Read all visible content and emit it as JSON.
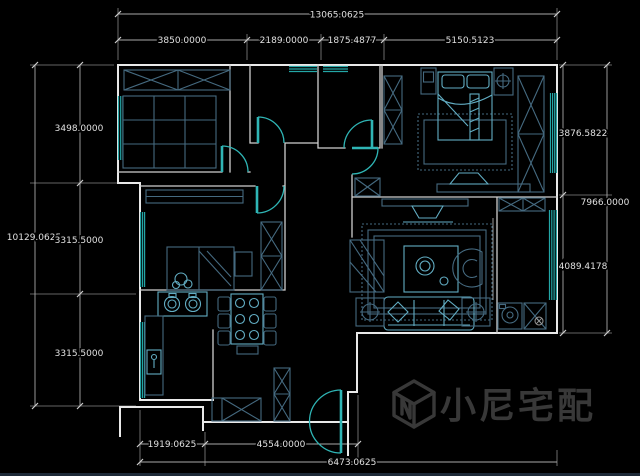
{
  "drawing": {
    "kind": "cad-floor-plan",
    "units": "mm"
  },
  "dimensions": {
    "top": {
      "overall": "13065.0625",
      "segments": [
        "3850.0000",
        "2189.0000",
        "1875.4877",
        "5150.5123"
      ]
    },
    "left": {
      "overall": "10129.0625",
      "segments": [
        "3498.0000",
        "3315.5000",
        "3315.5000"
      ]
    },
    "right": {
      "overall": "7966.0000",
      "segments": [
        "3876.5822",
        "4089.4178"
      ]
    },
    "bottom": {
      "overall": "6473.0625",
      "segments": [
        "1919.0625",
        "4554.0000"
      ]
    }
  },
  "watermark": {
    "text": "小尼宅配",
    "logo": "cube-n-logo"
  },
  "colors": {
    "background": "#000000",
    "wall": "#e9e9e9",
    "dimension_line": "#a8a8a8",
    "dimension_text": "#e0e0e0",
    "openings": "#2fb5b5",
    "furniture": "#456a80",
    "furniture_bright": "#62adc3",
    "watermark": "#383838"
  }
}
